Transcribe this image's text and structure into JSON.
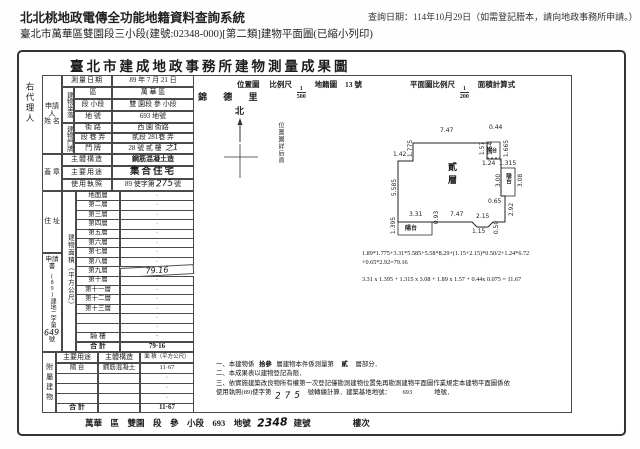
{
  "header": {
    "system_title": "北北桃地政電傳全功能地籍資料查詢系統",
    "query_date": "查詢日期：114年10月29日（如需登記謄本，請向地政事務所申請。）",
    "subtitle": "臺北市萬華區雙園段三小段(建號:02348-000)[第二類]建物平面圖(已縮小列印)"
  },
  "agent_label": "右代理人",
  "doc": {
    "title": "臺北市建成地政事務所建物測量成果圖",
    "applicant": {
      "l1": "申請人",
      "l2": "姓  名"
    },
    "survey": {
      "label": "測量日期",
      "value": "89 年 7 月 21 日"
    },
    "loc": {
      "group": "建物坐落",
      "r1l": "區",
      "r1v": "萬  華  區",
      "r2l": "段 小段",
      "r2v": "雙 園段 參 小段",
      "r3l": "地  號",
      "r3v": "693  地號"
    },
    "plate": {
      "group": "建物門牌",
      "r1l": "街  路",
      "r1v": "西 園  街路",
      "r2l": "段 巷 弄",
      "r2v": "貳段 281巷  弄",
      "r3l": "門  牌",
      "r3v": "28 號 貳 樓",
      "hand": "之1"
    },
    "seal": "蓋  章",
    "structure": {
      "label": "主體構造",
      "value": "鋼筋混凝土造"
    },
    "usage": {
      "label": "主要用途",
      "value": "集合住宅"
    },
    "license": {
      "label": "使用執照",
      "pre": "89 使字第",
      "hand": "275",
      "suf": "號"
    },
    "address_label": "住  址",
    "area_col": "建物面積（平方公尺）",
    "floors": [
      {
        "label": "地面層",
        "value": "·"
      },
      {
        "label": "第二層",
        "value": "·"
      },
      {
        "label": "第三層",
        "value": "·"
      },
      {
        "label": "第四層",
        "value": "·"
      },
      {
        "label": "第五層",
        "value": "·"
      },
      {
        "label": "第六層",
        "value": "·"
      },
      {
        "label": "第七層",
        "value": "·"
      },
      {
        "label": "第八層",
        "value": "·"
      },
      {
        "label": "第九層",
        "value": "79.16",
        "hand": true
      },
      {
        "label": "第十層",
        "value": "·"
      },
      {
        "label": "第十一層",
        "value": "·"
      },
      {
        "label": "第十二層",
        "value": "·"
      },
      {
        "label": "第十三層",
        "value": "·"
      },
      {
        "label": "",
        "value": "·"
      },
      {
        "label": "",
        "value": "·"
      }
    ],
    "qilou": {
      "label": "騎  樓",
      "value": "·"
    },
    "total": {
      "label": "合  計",
      "value": "79·16"
    },
    "appdoc": {
      "top": "申請書",
      "vert": "(89)建地二字第",
      "hand": "649",
      "suf": "號"
    },
    "annex": {
      "side": "附屬建物",
      "h1": "主要用途",
      "h2": "主體構造",
      "h3": "面 積（平方公尺）",
      "rows": [
        [
          "陽  台",
          "鋼筋混凝土",
          "11·67"
        ],
        [
          "",
          "",
          "·"
        ],
        [
          "",
          "",
          "·"
        ],
        [
          "",
          "",
          "·"
        ]
      ],
      "total_label": "合  計",
      "total_value": "11·67"
    },
    "footer": {
      "left": "萬華　區　雙園　段　參　小段　693　地號",
      "hand": "2348",
      "mid": "建號",
      "right": "樓次"
    }
  },
  "plan": {
    "loc_label": "位置圖",
    "scale_label": "比例尺",
    "frac1": {
      "n": "1",
      "d": "500"
    },
    "map_label": "地籍圖",
    "map_no": "13 號",
    "plan_scale_label": "平面圖比例尺",
    "frac2": {
      "n": "1",
      "d": "200"
    },
    "calc_label": "面積計算式",
    "village": "錦 德 里",
    "north": "北",
    "see_next": "位置圖詳后頁",
    "floor": "貳層",
    "balcony": "陽台",
    "dims": {
      "top": "7.47",
      "tl_v": "1.775",
      "l_step": "1.42",
      "left": "5.585",
      "bl_top": "3.31",
      "bl_left": "1.395",
      "bl_right": "0.93",
      "bottom": "7.47",
      "notch_top": "2.15",
      "notch_bot": "1.15",
      "notch_h": "0.50",
      "right": "2.92",
      "rb_top": "1.315",
      "rb_left": "3.00",
      "rb_right": "3.08",
      "rb_bot": "0.65",
      "tr_top": "0.44",
      "tr_left": "1.57",
      "tr_in": "1.54",
      "tr_right": "1.665",
      "tr_bot": "1.24"
    },
    "f1": "1.89*1.775+3.31*5.585+5.58*8.29+(1.15+2.15)*0.50/2+1.24*6.72",
    "f2": "+0.65*2.92=79.16",
    "f3": "3.31 x 1.395 + 1.315 x 3.08 + 1.89 x 1.57 + 0.44x 0.075 = 11.67"
  },
  "notes": {
    "l1a": "一、本建物係",
    "l1hand": "拾參",
    "l1b": "層建物本件係測量第",
    "l1hand2": "貳",
    "l1c": "層部分．",
    "l2": "二、本成果表以建物登記為限．",
    "l3": "三、依實施建築改良物所有權第一次登記僅勘測建物位置免再勘測建物平面圖作業規定本建物平面圖係依",
    "l4a": "使用執照(89)使字第",
    "l4hand": "275",
    "l4b": "號轉繪計算．建築基地地號：",
    "l4c": "693",
    "l4d": "　地號．"
  }
}
